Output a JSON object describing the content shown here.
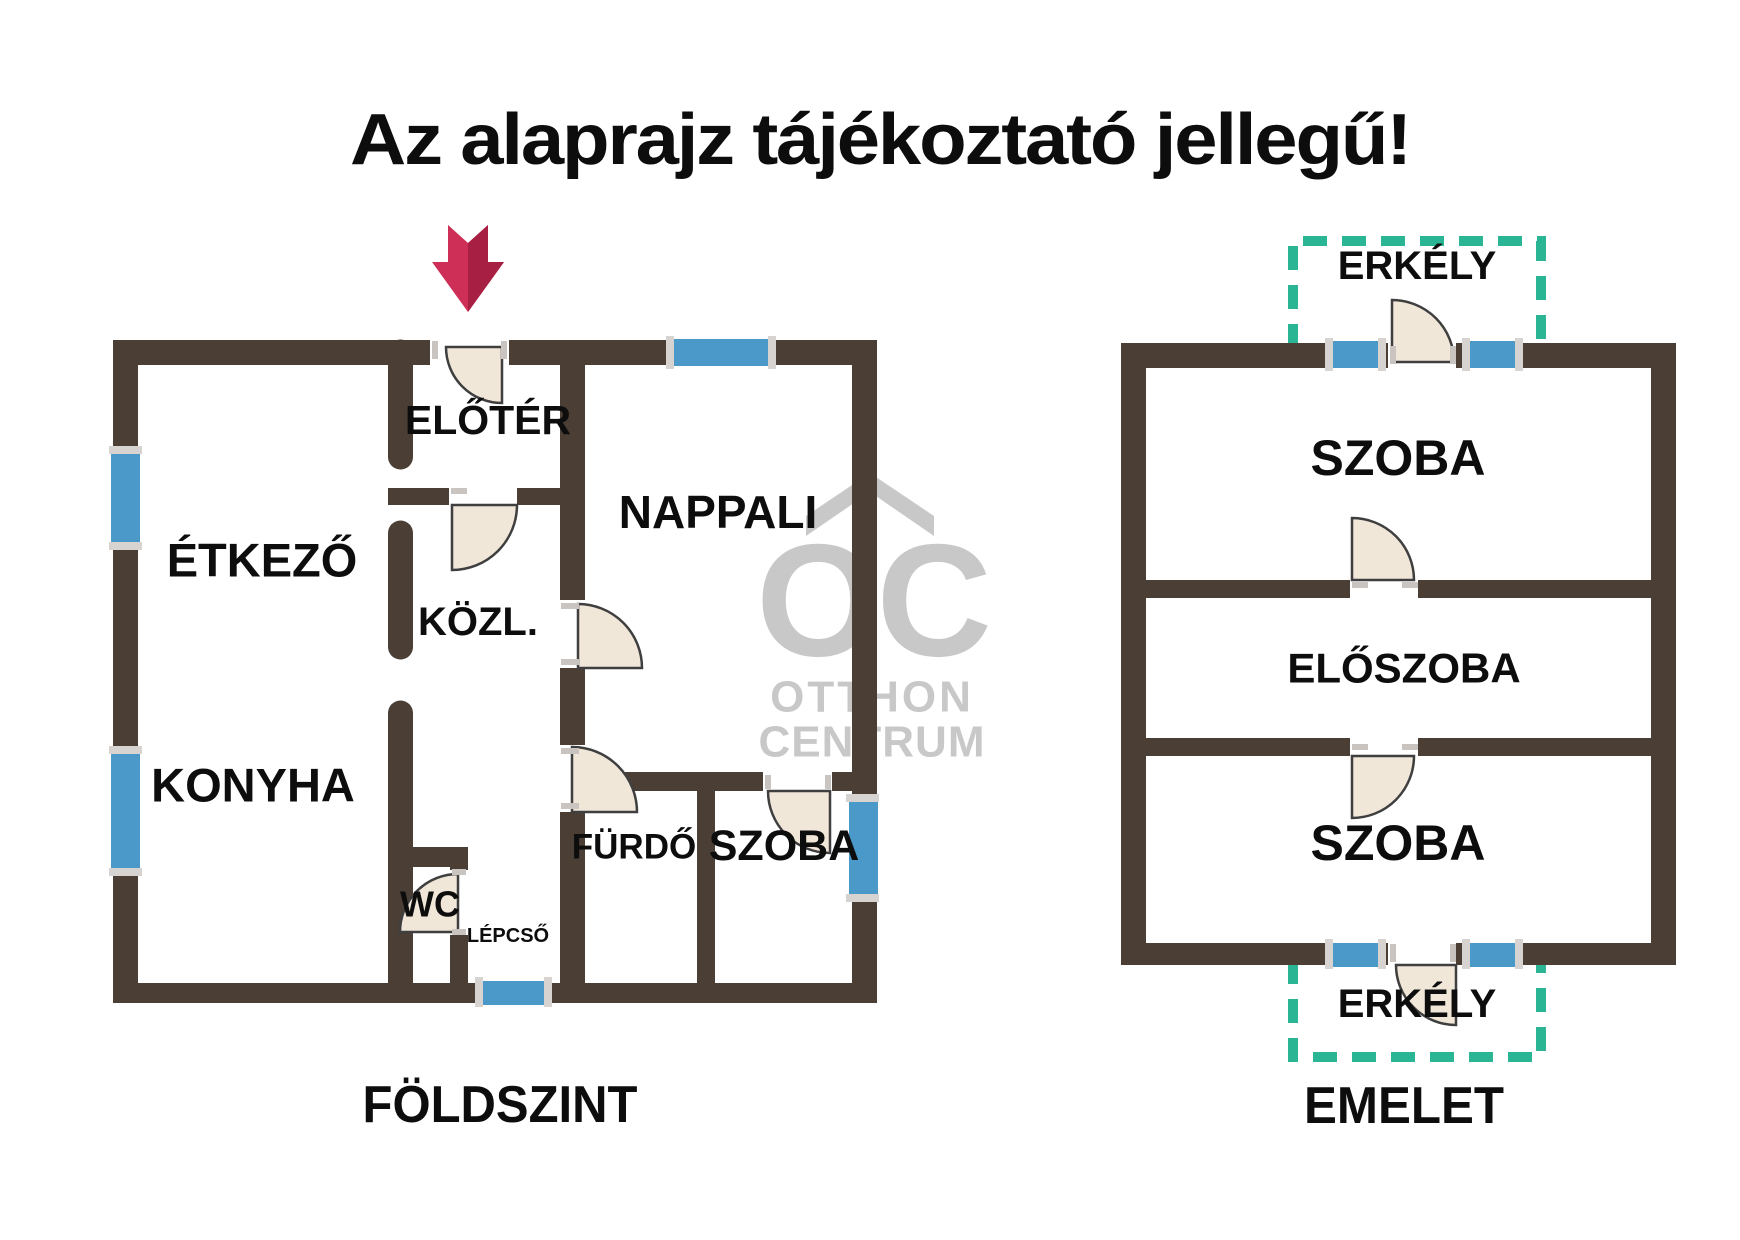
{
  "title": "Az alaprajz tájékoztató jellegű!",
  "watermark": {
    "logo": "OC",
    "line1": "OTTHON",
    "line2": "CENTRUM"
  },
  "colors": {
    "wall": "#4a3e35",
    "window_blue": "#4a99c8",
    "window_cap": "#d6d3d0",
    "balcony_teal": "#2ab694",
    "door_fill": "#f1e7d9",
    "door_stroke": "#3f3f3f",
    "arrow_red": "#cd2f56",
    "arrow_red_dark": "#a81f44",
    "watermark_gray": "#c8c8c8",
    "text_black": "#0d0d0d"
  },
  "ground_floor": {
    "name": "FÖLDSZINT",
    "rooms": {
      "eloter": "ELŐTÉR",
      "etkezo": "ÉTKEZŐ",
      "nappali": "NAPPALI",
      "kozl": "KÖZL.",
      "konyha": "KONYHA",
      "furdo": "FÜRDŐ",
      "szoba": "SZOBA",
      "wc": "WC",
      "lepcso": "LÉPCSŐ"
    }
  },
  "upper_floor": {
    "name": "EMELET",
    "rooms": {
      "erkely_top": "ERKÉLY",
      "szoba_top": "SZOBA",
      "eloszoba": "ELŐSZOBA",
      "szoba_bottom": "SZOBA",
      "erkely_bottom": "ERKÉLY"
    }
  }
}
